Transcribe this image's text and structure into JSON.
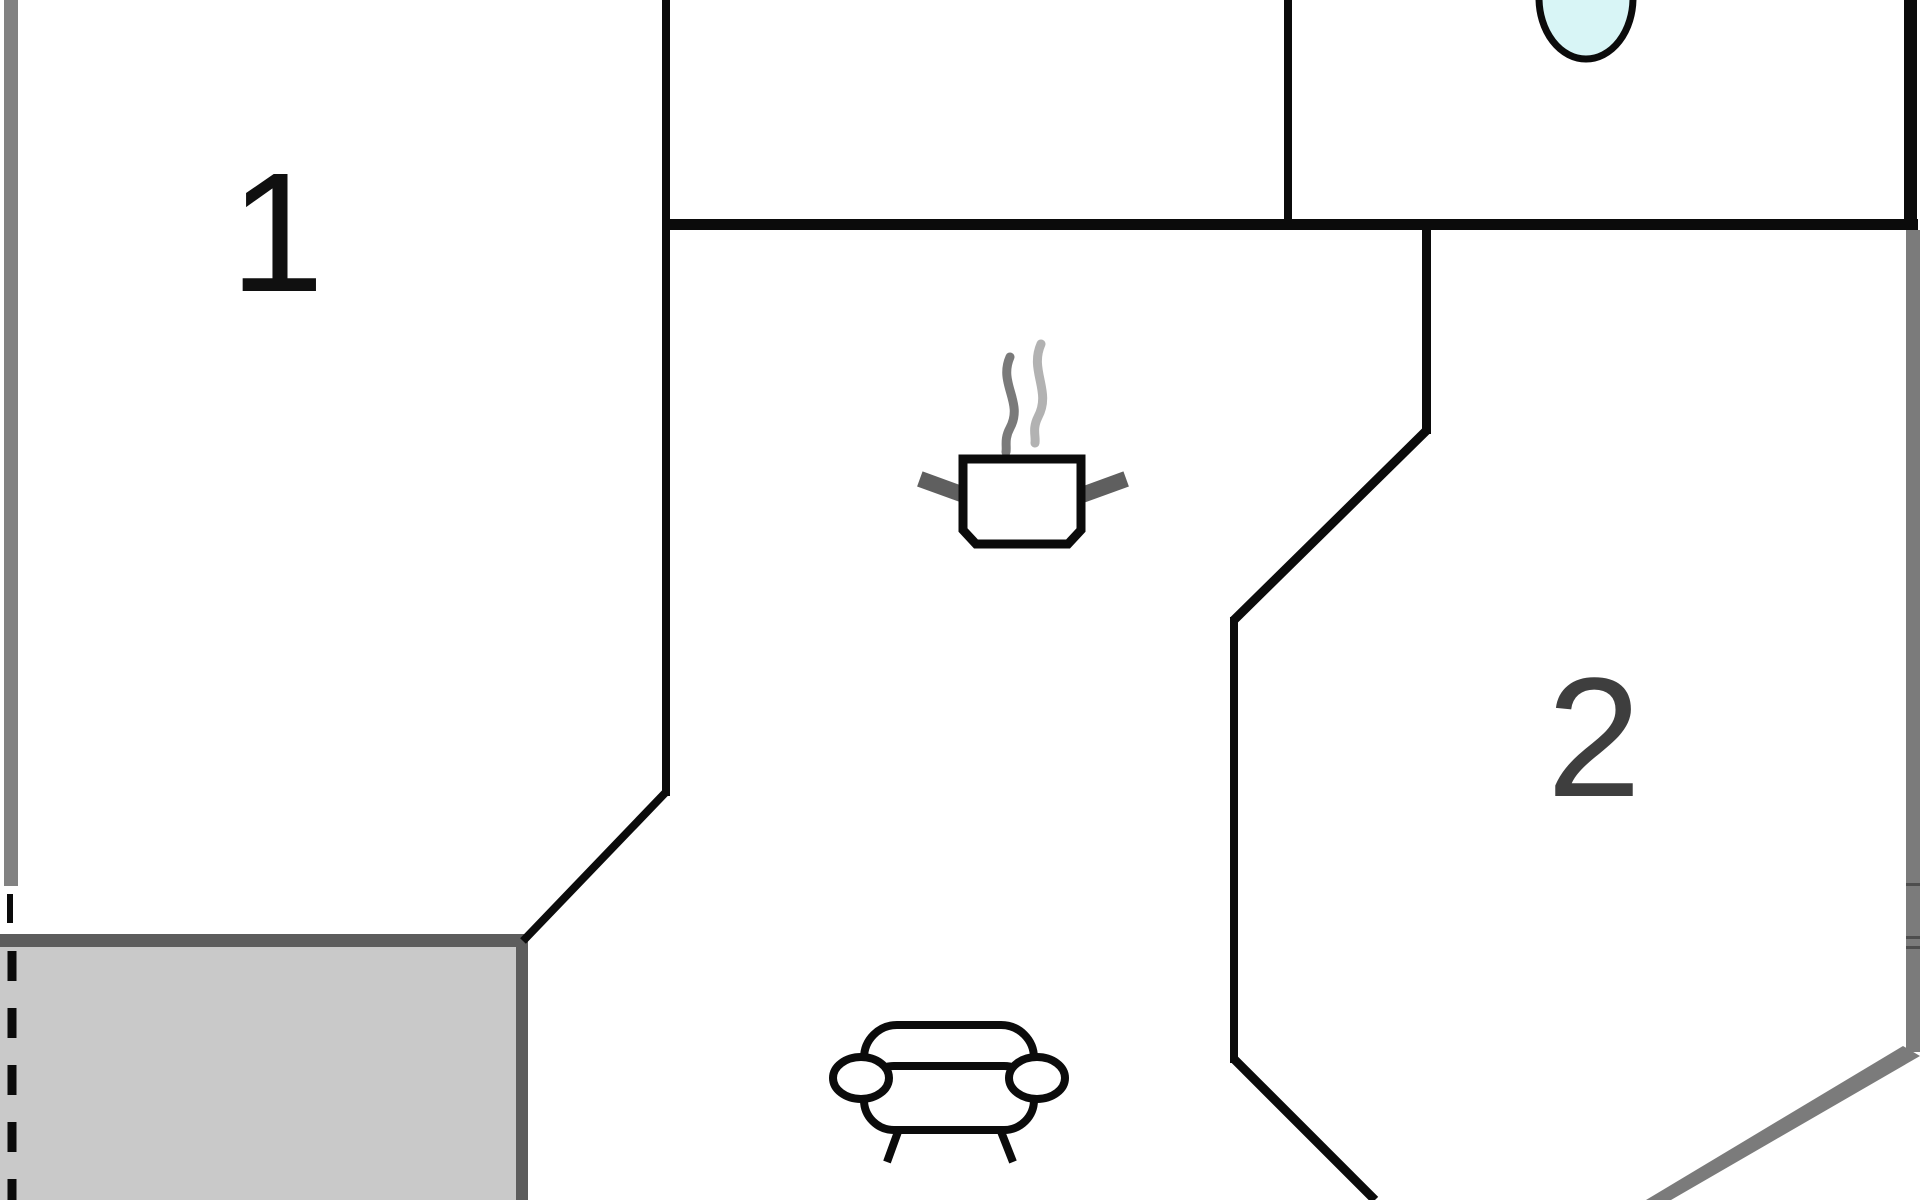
{
  "plan": {
    "type": "floor-plan",
    "rooms": [
      {
        "id": "room-1",
        "label": "1"
      },
      {
        "id": "room-2",
        "label": "2"
      }
    ],
    "icons": [
      {
        "name": "stove-pot-icon",
        "meaning": "kitchen cooking pot with steam"
      },
      {
        "name": "sofa-icon",
        "meaning": "living area sofa (top view)"
      },
      {
        "name": "washbasin-icon",
        "meaning": "bathroom basin"
      }
    ],
    "areas": [
      {
        "name": "terrace",
        "style": "gray hatch-free fill, dashed open left edge"
      }
    ],
    "theme": {
      "wall": "#0b0b0b",
      "outer-gray": "#828282",
      "right-gray": "#7b7b7b",
      "terrace-border": "#5d5d5d",
      "terrace-fill": "#c9c9c9",
      "sink-fill": "#d8f5f6",
      "steam-dark": "#7a7a7a",
      "steam-light": "#b2b2b2",
      "handle-gray": "#5f5f5f",
      "label1": "#101010",
      "label2": "#3e3e3e",
      "floor": "#ffffff"
    }
  }
}
